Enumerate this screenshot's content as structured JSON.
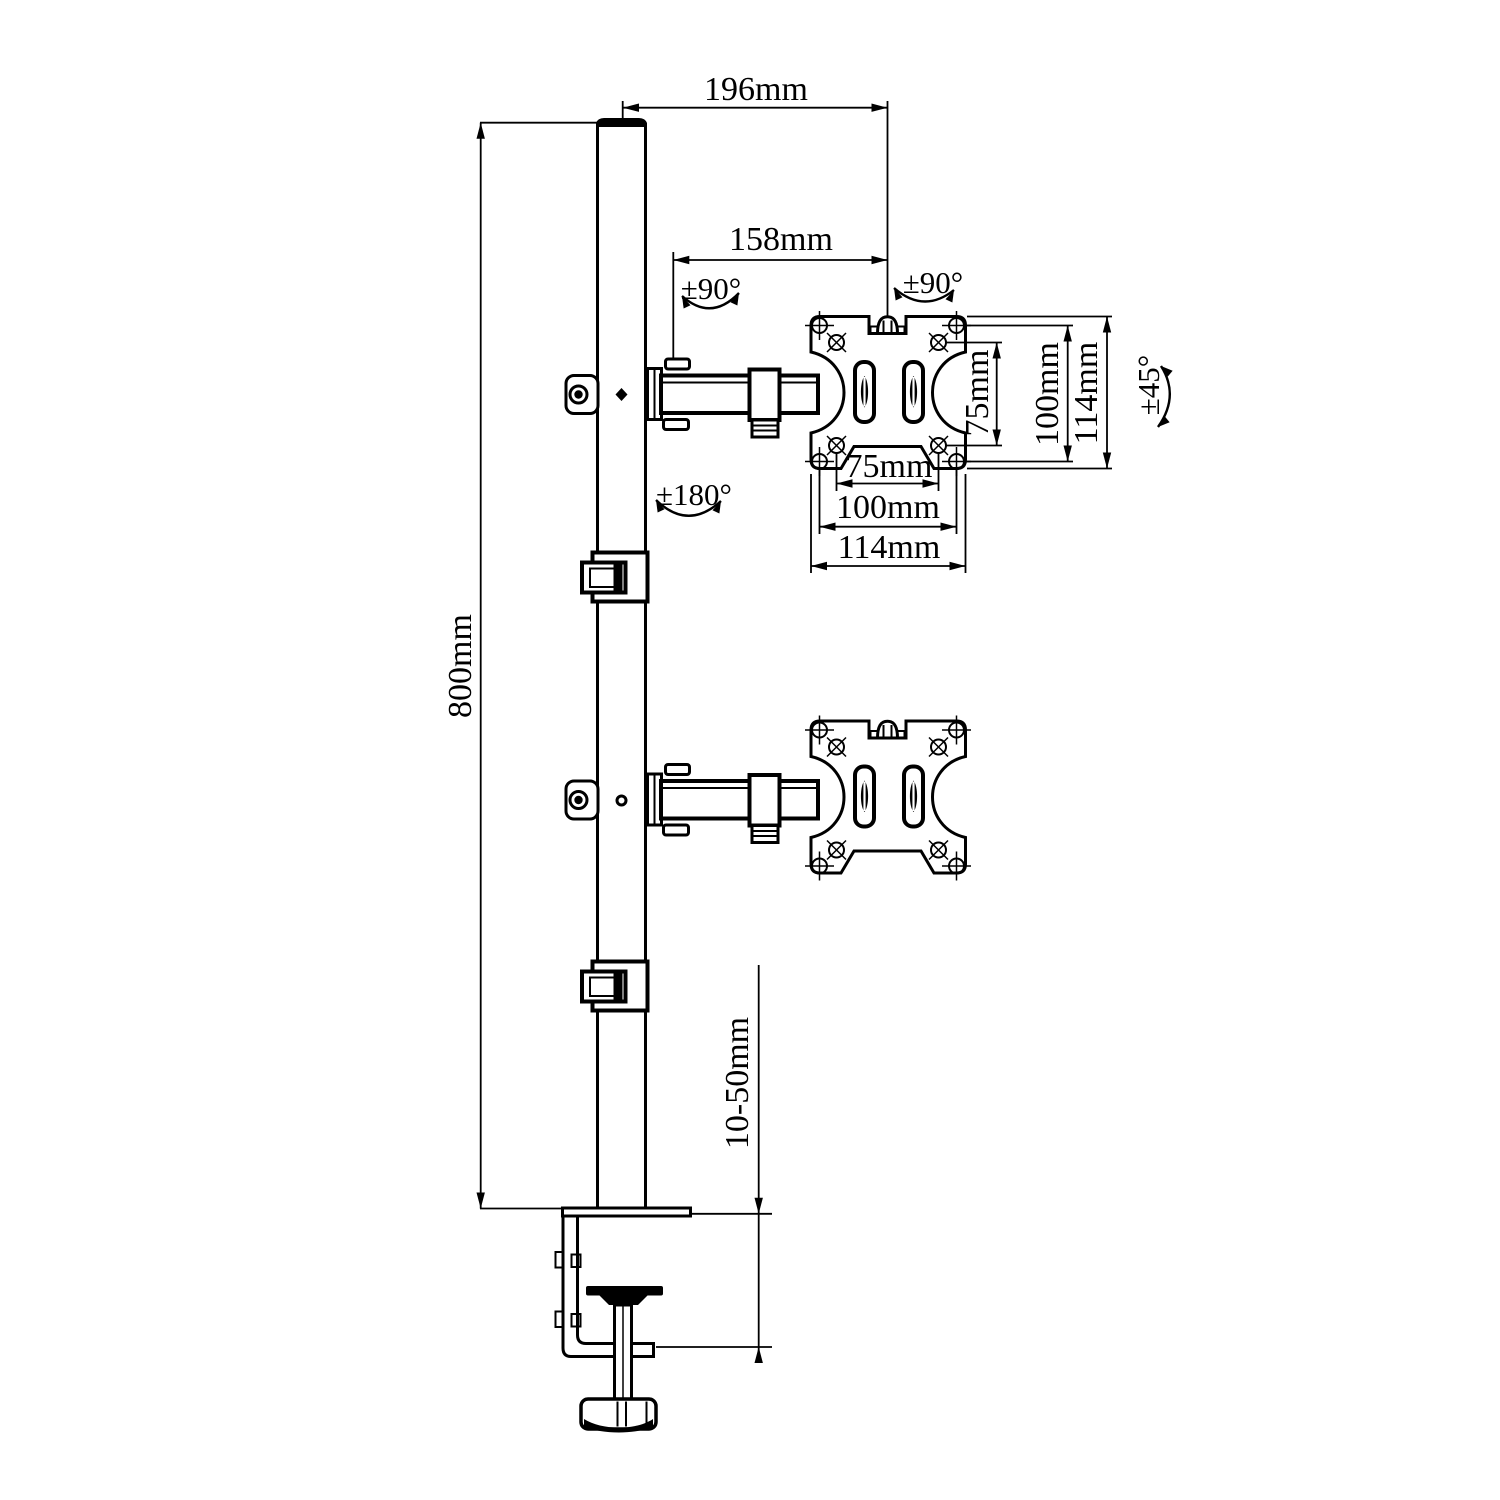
{
  "drawing": {
    "background": "#ffffff",
    "line_color": "#000000",
    "labels": {
      "offset_196": "196mm",
      "arm_158": "158mm",
      "pole_800": "800mm",
      "clamp_range": "10-50mm",
      "swivel_left": "±90°",
      "swivel_right": "±90°",
      "rotate_180": "±180°",
      "tilt_45": "±45°",
      "vesa_v_inner": "75mm",
      "vesa_v_outer": "100mm",
      "vesa_v_plate": "114mm",
      "vesa_h_inner": "75mm",
      "vesa_h_outer": "100mm",
      "vesa_h_plate": "114mm"
    }
  }
}
